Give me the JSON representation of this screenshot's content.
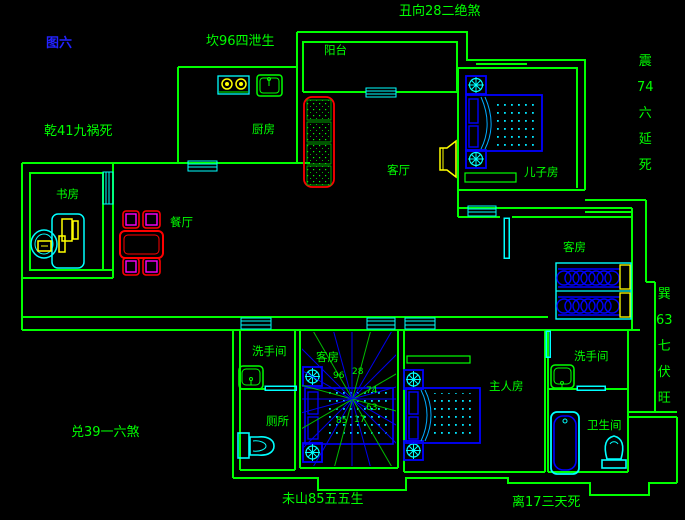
{
  "figure_title": "图六",
  "perimeter_annotations": {
    "chou_top": "丑向28二绝煞",
    "kan_top_left": "坎96四泄生",
    "qian_left": "乾41九祸死",
    "dui_bottom_left": "兑39一六煞",
    "wei_bottom": "未山85五五生",
    "li_bottom_right": "离17三天死",
    "zhen_right": "震74六延死",
    "xun_right": "巽63七伏旺"
  },
  "room_labels": {
    "balcony": "阳台",
    "kitchen": "厨房",
    "living_room": "客厅",
    "sons_room": "儿子房",
    "study": "书房",
    "dining_room": "餐厅",
    "guest_room_right": "客房",
    "guest_room_center": "客房",
    "washroom_left": "洗手间",
    "toilet": "厕所",
    "master_room": "主人房",
    "washroom_right": "洗手间",
    "bathroom": "卫生间"
  },
  "compass": {
    "numbers": [
      "96",
      "28",
      "74",
      "63",
      "17",
      "85"
    ]
  },
  "colors": {
    "background": "#000000",
    "wall_green": "#00ff00",
    "window_door_cyan": "#00ffff",
    "furniture_blue": "#0000ff",
    "accent_yellow": "#ffff00",
    "sofa_red": "#ff0000",
    "chair_magenta": "#ff00ff",
    "title_blue": "#2222ff"
  }
}
